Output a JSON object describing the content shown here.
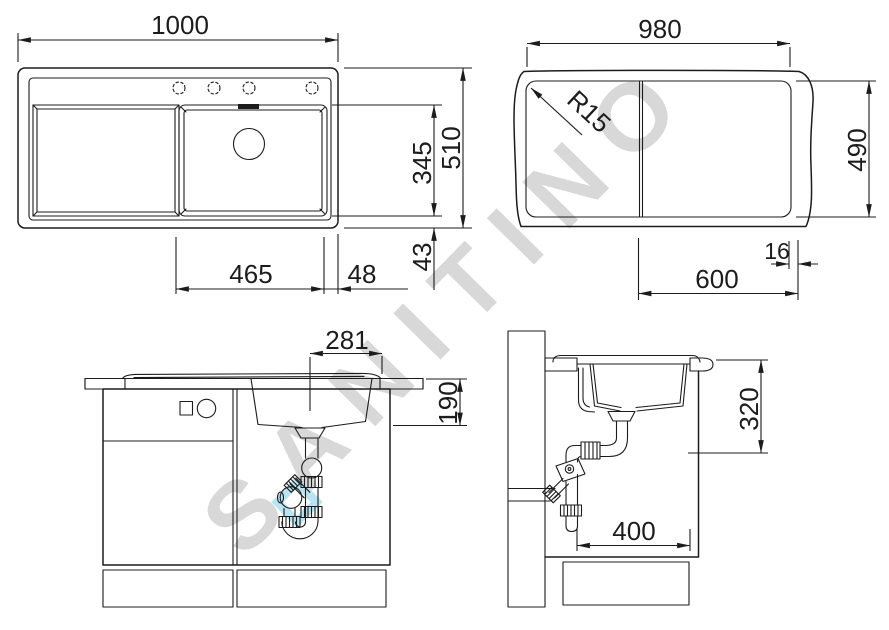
{
  "watermark": {
    "text": "SANITINO",
    "color": "#d8d8d8",
    "logo_color": "#b9e5f3"
  },
  "colors": {
    "line": "#1c1c1c",
    "background": "#ffffff"
  },
  "plan_view": {
    "overall_width": "1000",
    "overall_depth": "510",
    "bowl_depth": "345",
    "rear_gap": "43",
    "bowl_width": "465",
    "bowl_right_offset": "48"
  },
  "cutout_view": {
    "cutout_width": "980",
    "cutout_depth": "490",
    "corner_radius": "R15",
    "edge_offset": "16",
    "bowl_zone_width": "600"
  },
  "front_view": {
    "drain_to_edge": "281",
    "bowl_depth": "190"
  },
  "side_view": {
    "outlet_height": "320",
    "trap_clearance": "400"
  }
}
